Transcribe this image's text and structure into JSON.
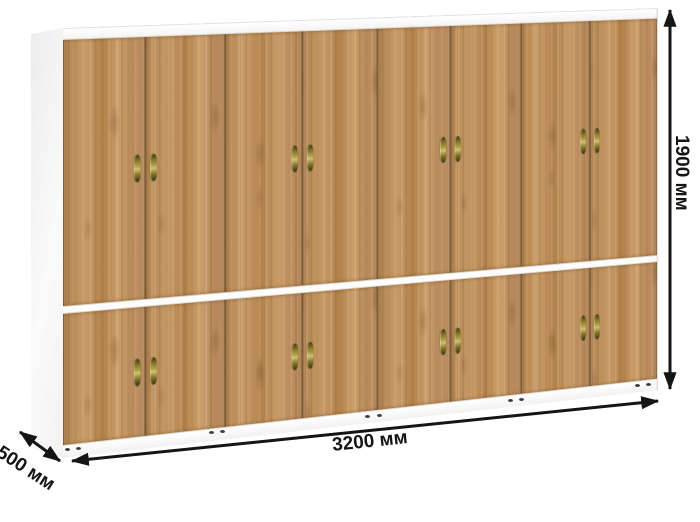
{
  "dimensions": {
    "height": "1900 мм",
    "width": "3200 мм",
    "depth": "500 мм"
  },
  "structure": {
    "upper_doors": 8,
    "lower_doors": 8,
    "handle_pairs_per_row": 4
  },
  "colors": {
    "wood": "#bc8f5c",
    "wood_dark": "#9f764a",
    "wood_light": "#cb9e6b",
    "panel_white": "#fbfbfb",
    "handle_brass": "#8a7a2c",
    "dimension_ink": "#151515",
    "background": "#ffffff"
  }
}
